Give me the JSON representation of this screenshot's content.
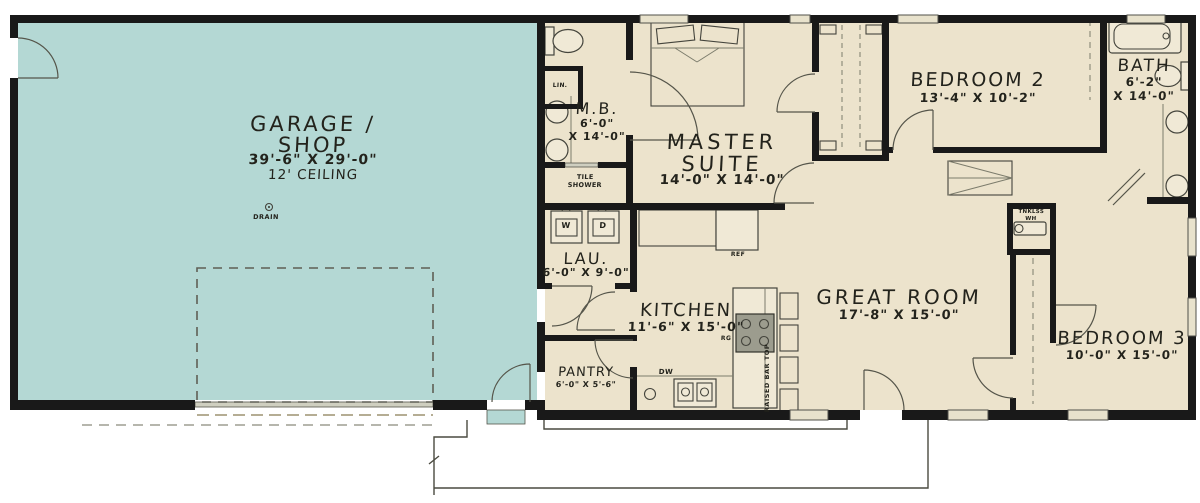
{
  "plan": {
    "garage": {
      "title_line1": "GARAGE /",
      "title_line2": "SHOP",
      "dims": "39'-6\" X 29'-0\"",
      "ceiling": "12' CEILING",
      "drain_label": "DRAIN"
    },
    "master_bath": {
      "name": "M.B.",
      "dim_line1": "6'-0\"",
      "dim_line2": "X 14'-0\"",
      "linen": "LIN.",
      "shower_line1": "TILE",
      "shower_line2": "SHOWER"
    },
    "master_suite": {
      "name_line1": "MASTER",
      "name_line2": "SUITE",
      "dims": "14'-0\" X 14'-0\""
    },
    "bedroom2": {
      "name": "BEDROOM 2",
      "dims": "13'-4\" X 10'-2\""
    },
    "bath": {
      "name": "BATH",
      "dim_line1": "6'-2\"",
      "dim_line2": "X 14'-0\""
    },
    "laundry": {
      "name": "LAU.",
      "dims": "6'-0\" X 9'-0\"",
      "washer": "W",
      "dryer": "D"
    },
    "kitchen": {
      "name": "KITCHEN",
      "dims": "11'-6\" X 15'-0\"",
      "fridge": "REF",
      "range": "RG",
      "dishwasher": "DW",
      "bar": "RAISED BAR TOP"
    },
    "pantry": {
      "name": "PANTRY",
      "dims": "6'-0\" X 5'-6\""
    },
    "great_room": {
      "name": "GREAT ROOM",
      "dims": "17'-8\" X 15'-0\""
    },
    "bedroom3": {
      "name": "BEDROOM 3",
      "dims": "10'-0\" X 15'-0\""
    },
    "utility": {
      "water_heater_line1": "TNKLSS",
      "water_heater_line2": "WH"
    }
  },
  "colors": {
    "garage_fill": "#b4d8d4",
    "floor_fill": "#ece3cc",
    "wall": "#191919"
  }
}
